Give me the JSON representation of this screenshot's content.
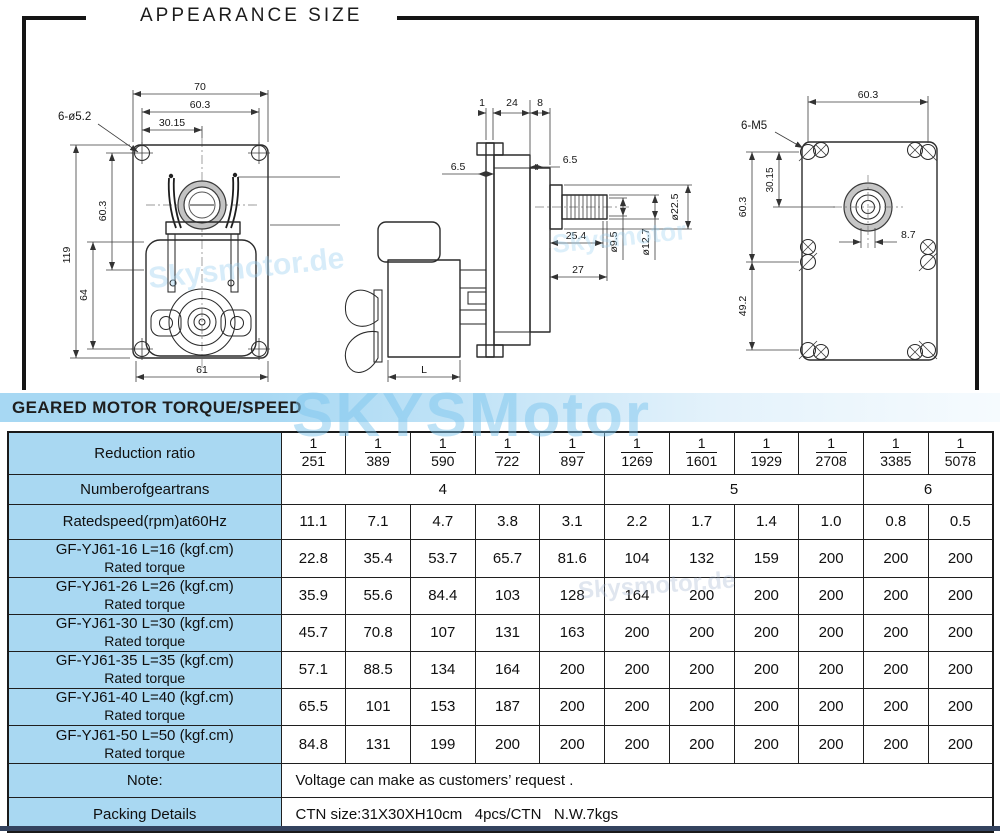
{
  "title": "APPEARANCE SIZE",
  "banner": "GEARED MOTOR TORQUE/SPEED",
  "colors": {
    "label_blue": "#a9d8f2",
    "banner_blue": "#a7d8f3",
    "bottom_bar": "#34435f",
    "watermark_blue": "#7dc6ee"
  },
  "watermarks": {
    "big": "SKYSMotor",
    "mid1": "Skysmotor.de",
    "mid2": "Skysmotor",
    "table": "Skysmotor.de"
  },
  "drawings": {
    "front_view": {
      "dims": {
        "top_width": "70",
        "hole_span": "60.3",
        "half_span": "30.15",
        "holes_callout": "6-ø5.2",
        "height": "119",
        "upper_height": "60.3",
        "lower_height": "64",
        "wire_length": "500±20",
        "bottom_width": "61"
      }
    },
    "side_view": {
      "dims": {
        "plate": "1",
        "body": "24",
        "cover": "8",
        "left_offset": "6.5",
        "right_offset": "6.5",
        "spline_len": "25.4",
        "shaft_len": "27",
        "core_dia": "ø9.5",
        "shaft_dia": "ø12.7",
        "boss_dia": "ø22.5",
        "motor_len": "L"
      }
    },
    "rear_view": {
      "dims": {
        "hole_span": "60.3",
        "screw_callout": "6-M5",
        "half_span": "30.15",
        "upper_height": "60.3",
        "lower_height": "49.2",
        "shaft_flat": "8.7"
      }
    }
  },
  "table": {
    "reduction_label": "Reduction ratio",
    "ratio_numerator": "1",
    "ratios": [
      "251",
      "389",
      "590",
      "722",
      "897",
      "1269",
      "1601",
      "1929",
      "2708",
      "3385",
      "5078"
    ],
    "geartrans_label": "Numberofgeartrans",
    "geartrans": [
      "4",
      "5",
      "6"
    ],
    "speed_label": "Ratedspeed(rpm)at60Hz",
    "speeds": [
      "11.1",
      "7.1",
      "4.7",
      "3.8",
      "3.1",
      "2.2",
      "1.7",
      "1.4",
      "1.0",
      "0.8",
      "0.5"
    ],
    "torque_rows": [
      {
        "model": "GF-YJ61-16 L=16 (kgf.cm)",
        "sub": "Rated torque",
        "values": [
          "22.8",
          "35.4",
          "53.7",
          "65.7",
          "81.6",
          "104",
          "132",
          "159",
          "200",
          "200",
          "200"
        ]
      },
      {
        "model": "GF-YJ61-26 L=26 (kgf.cm)",
        "sub": "Rated torque",
        "values": [
          "35.9",
          "55.6",
          "84.4",
          "103",
          "128",
          "164",
          "200",
          "200",
          "200",
          "200",
          "200"
        ]
      },
      {
        "model": "GF-YJ61-30 L=30 (kgf.cm)",
        "sub": "Rated torque",
        "values": [
          "45.7",
          "70.8",
          "107",
          "131",
          "163",
          "200",
          "200",
          "200",
          "200",
          "200",
          "200"
        ]
      },
      {
        "model": "GF-YJ61-35 L=35 (kgf.cm)",
        "sub": "Rated torque",
        "values": [
          "57.1",
          "88.5",
          "134",
          "164",
          "200",
          "200",
          "200",
          "200",
          "200",
          "200",
          "200"
        ]
      },
      {
        "model": "GF-YJ61-40 L=40 (kgf.cm)",
        "sub": "Rated torque",
        "values": [
          "65.5",
          "101",
          "153",
          "187",
          "200",
          "200",
          "200",
          "200",
          "200",
          "200",
          "200"
        ]
      },
      {
        "model": "GF-YJ61-50 L=50 (kgf.cm)",
        "sub": "Rated torque",
        "values": [
          "84.8",
          "131",
          "199",
          "200",
          "200",
          "200",
          "200",
          "200",
          "200",
          "200",
          "200"
        ]
      }
    ],
    "note_label": "Note:",
    "note": "Voltage can make as customers’ request .",
    "packing_label": "Packing Details",
    "packing": "CTN size:31X30XH10cm   4pcs/CTN   N.W.7kgs"
  }
}
